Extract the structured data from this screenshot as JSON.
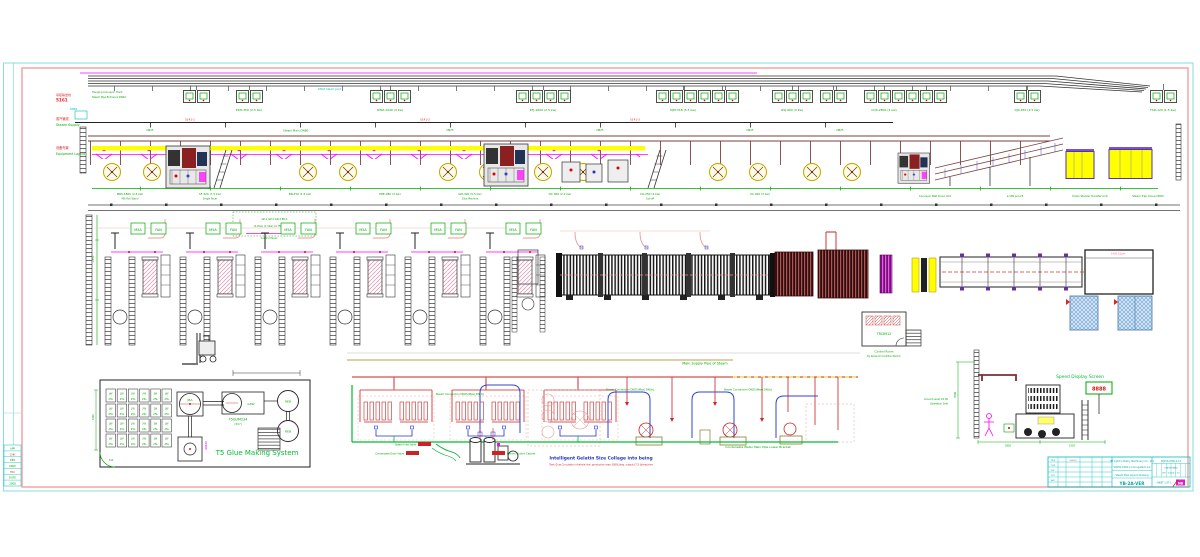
{
  "frame": {
    "rows": [
      "APP",
      "CHK",
      "DES",
      "DRW",
      "TRC",
      "DATE",
      "2008"
    ]
  },
  "sections": {
    "s1": {
      "code": "吊挂输送线",
      "sub": "5161",
      "note1": "Hanging Conveyor Track",
      "note2": "Steam Pipe Entrance DN40"
    },
    "s2": {
      "code": "蒸汽管线",
      "en": "Steam Supply",
      "dn": "DN80"
    },
    "s3": {
      "code": "设备布置",
      "en": "Equipment Layout"
    }
  },
  "conveyor": {
    "stations": [
      "EKH-350 (2.5 kw)",
      "DWZ-2240 (4 kw)",
      "KFJ-1600 (2.5 kw)",
      "MJH-318 (5.5 kw)",
      "GSJ-900 (3 kw)",
      "CQS-2800 (4 kw)",
      "DJX-450 (2.5 kw)",
      "TSD-120 (1.5 kw)"
    ],
    "cyan_note": "DN40 Steam Joint"
  },
  "steam": {
    "main_label": "Steam Main DN80",
    "tap_label": "DN25",
    "tags": [
      "5141-1",
      "5141-2",
      "5141-3"
    ]
  },
  "equipment": {
    "dims": [
      "MRS-1800 (2.5 kw)",
      "SF-320 (7.5 kw)",
      "BR-250 (1.5 kw)",
      "PRE-280 (4 kw)",
      "GM-320 (5.5 kw)",
      "DC-300 (2.2 kw)",
      "CO-250 (4 kw)",
      "SC-920 (3 kw)"
    ],
    "names": [
      "Mill Roll Stand",
      "Single Facer",
      "Glue Machine",
      "Cut-off"
    ],
    "right_labels": [
      "Conveyor Belt Drive Unit",
      "a-500 pcs×8",
      "Down Stacker Transfer Unit",
      "Steam Trap Group DN25"
    ]
  },
  "floor2": {
    "dim_v": "2350",
    "legend1": "GP-1  GP-2  GR-3  PR-4",
    "legend2": "(2.2kw) (1.5kw) (0.75kw) (1.5kw)",
    "panel_label": "Control Panel",
    "box_a": "M5A",
    "box_b": "FAN",
    "conveyor_tag": "1400 S2pm",
    "cr_tag": "TRC8912",
    "cr_line1": "Control Room",
    "cr_line2": "By Series Or Condition Electric"
  },
  "glue": {
    "title": "T5 Glue Making System",
    "cell_l1": "JW",
    "cell_l2": "25L",
    "mixer": "JBA",
    "tank": "GSW",
    "tank_code": "T5GUM234",
    "tank_note": "(3m³)",
    "reb_top": "REB",
    "reb_bot": "REB",
    "riser": "40888",
    "corner_label": "R15",
    "dim_v": "1800"
  },
  "piping": {
    "title": "Main Supply Pipe of Steam",
    "conn1": "Steam Connection DN25(Max) DN(in)",
    "conn2": "Steam Connection DN25(Max) DN(in)",
    "conn3": "Steam Connection DN25(Max) DN(in)",
    "condensate": "Condensate Water Main Pipe Lower Bracket",
    "blue_note": "Intelligent Gelatin Size Collage into being",
    "red_note": "Tank Glue Circulation of whole line, production max 3000L/day, output (7.5 t)/machine",
    "lbl_inlet": "Steam Inlet Valve",
    "lbl_outlet": "Condensate Drain Valve",
    "lbl_cabinet": "Electric Control Cabinet"
  },
  "speed": {
    "title": "Speed Display Screen",
    "led": "8888",
    "ground": "Ground Level ±0.00",
    "side": "Operation Side",
    "dim_v": "3500",
    "dims": [
      "2850",
      "1520"
    ]
  },
  "title_block": {
    "left_rows": [
      "DES",
      "CHK",
      "PRC",
      "STD",
      "APP"
    ],
    "left_date": "2008.5",
    "company": "HB Light Industry Machinery Co., Ltd.",
    "project": "WJ250-2500-2 Corrugated Line",
    "subtitle": "Steam Pipe Layout Drawing",
    "drawing_no": "YB-2A-VER",
    "doc_no": "WJ250-2500-2-14",
    "stage1": "STAGE MARK",
    "stage2": "WT · SCALE 1:50",
    "sheet_row": "SHEET 1 OF 1",
    "logo": "NB"
  }
}
